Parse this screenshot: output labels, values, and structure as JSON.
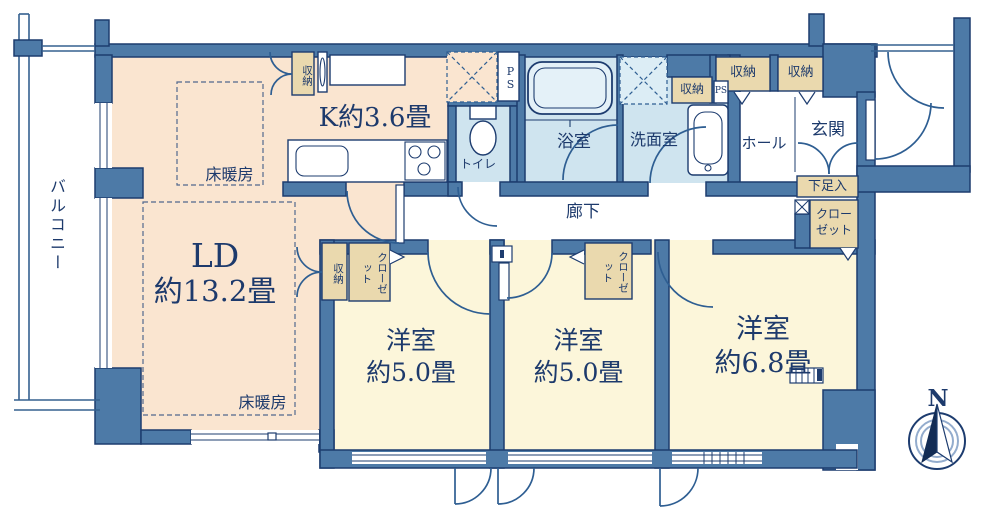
{
  "floorplan": {
    "balcony": "バルコニー",
    "kitchen": "K約3.6畳",
    "living_dining": {
      "name": "LD",
      "size": "約13.2畳"
    },
    "floor_heating": "床暖房",
    "bedrooms": [
      {
        "type": "洋室",
        "size": "約5.0畳"
      },
      {
        "type": "洋室",
        "size": "約5.0畳"
      },
      {
        "type": "洋室",
        "size": "約6.8畳"
      }
    ],
    "toilet": "トイレ",
    "bath": "浴室",
    "washroom": "洗面室",
    "corridor": "廊下",
    "hall": "ホール",
    "entrance": "玄関",
    "shoe_cabinet": "下足入",
    "closet": "クローゼット",
    "storage": "収納",
    "pipe_space": "PS",
    "compass_north": "N",
    "colors": {
      "wall": "#4d7aa7",
      "outline": "#1d3c6f",
      "ldk-floor": "#fae5d0",
      "bedroom-floor": "#fcf6da",
      "wet-floor": "#cfe4ef",
      "storage-box": "#ead9ae",
      "text": "#1d3a6c"
    }
  }
}
